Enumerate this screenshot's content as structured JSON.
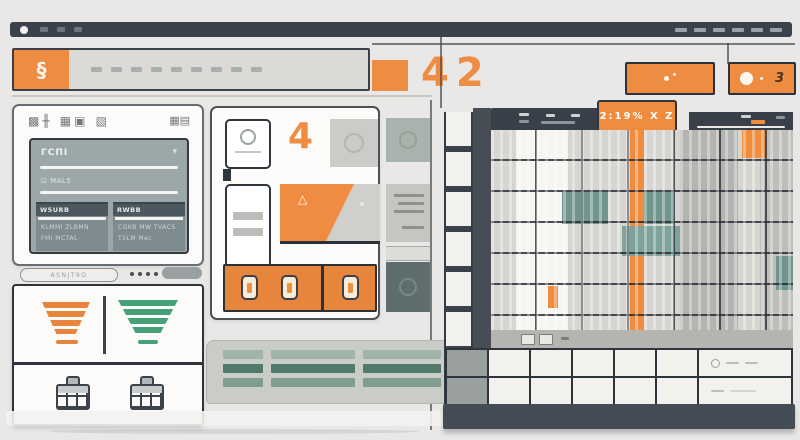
{
  "window": {
    "control_square_count": 3,
    "right_dash_count": 6
  },
  "header": {
    "logo_glyph": "§",
    "menu_dash_count": 9,
    "digits": "42",
    "actions_button": {
      "icon": "sparkle-dots"
    },
    "notification_button": {
      "label": "3",
      "icon": "status-circle"
    }
  },
  "left_panel": {
    "title_glyphs": "▩╫ ▦▣ ▧",
    "corner_glyphs": "▦▤",
    "form": {
      "field1_label": "ΓCΠI",
      "field1_caret": "▾",
      "field2_label": "⊡ MAL5",
      "box1": {
        "header": "W5URB",
        "line1": "KLMMI ZLBMN",
        "line2": "FMI MCTAL"
      },
      "box2": {
        "header": "RWBB",
        "line1": "CGKB MW TVACS",
        "line2": "T5LM Mec"
      }
    }
  },
  "filter_row": {
    "pill_label": "ASNJT9O",
    "dot_count": 4
  },
  "stats_card": {
    "funnel_orange": "#e8853c",
    "funnel_green": "#46a078"
  },
  "middle_panel": {
    "badge_number": "4",
    "card_glyph": "△"
  },
  "building": {
    "tab_label": "2:19% X Z",
    "row_cell_count": 5
  },
  "colors": {
    "accent_orange": "#ee8c42",
    "slate": "#3a424c",
    "teal": "#5f8a7d",
    "green": "#46a078"
  }
}
